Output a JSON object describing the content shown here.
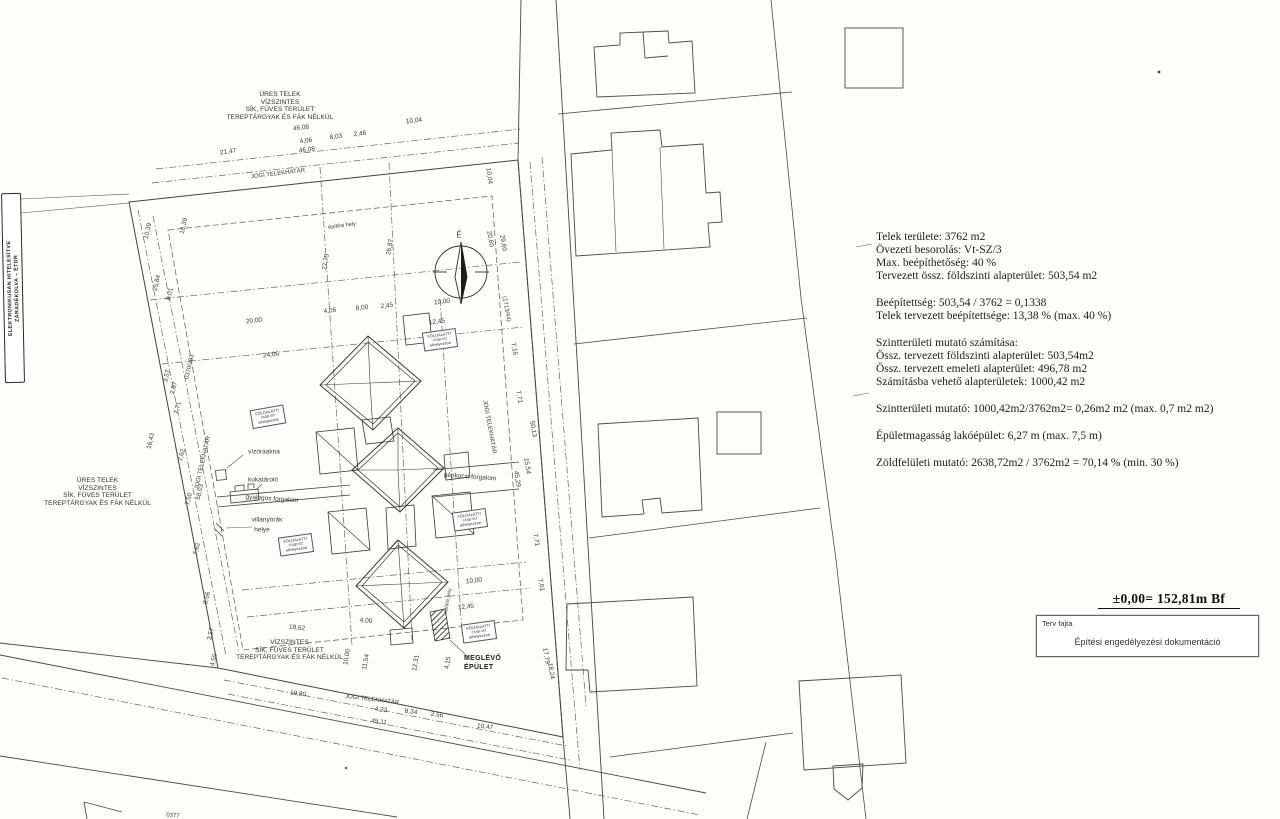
{
  "stamp": {
    "line1": "ELEKTRONIKUSAN HITELESÍTVE",
    "line2": "ZÁRADÉKOLVA – ÉTDR"
  },
  "notes": {
    "top_left": [
      "ÜRES TELEK",
      "VÍZSZINTES",
      "SÍK, FÜVES TERÜLET",
      "TEREPTÁRGYAK ÉS FÁK NÉLKÜL"
    ],
    "left": [
      "ÜRES TELEK",
      "VÍZSZINTES",
      "SÍK, FÜVES TERÜLET",
      "TEREPTÁRGYAK ÉS FÁK NÉLKÜL"
    ],
    "bottom": [
      "VÍZSZINTES",
      "SÍK, FÜVES TERÜLET",
      "TEREPTÁRGYAK ÉS FÁK NÉLKÜL"
    ]
  },
  "info_block": {
    "paragraphs": [
      [
        "Telek területe: 3762 m2",
        "Övezeti besorolás: Vt-SZ/3",
        "Max. beépíthetőség: 40 %",
        "Tervezett össz. földszinti alapterület: 503,54 m2"
      ],
      [
        "Beépítettség: 503,54 / 3762 = 0,1338",
        "Telek tervezett beépítettsége: 13,38 % (max. 40 %)"
      ],
      [
        "Szintterületi mutató számítása:",
        "Össz. tervezett földszinti alapterület: 503,54m2",
        "Össz. tervezett emeleti alapterület: 496,78 m2",
        "Számításba vehető alapterületek: 1000,42 m2"
      ],
      [
        "Szintterületi mutató: 1000,42m2/3762m2= 0,26m2 m2  (max. 0,7 m2 m2)"
      ],
      [
        "Épületmagasság lakóépület: 6,27 m (max. 7,5 m)"
      ],
      [
        "Zöldfelületi mutató: 2638,72m2 / 3762m2 = 70,14 % (min. 30 %)"
      ]
    ]
  },
  "datum": "±0,00= 152,81m Bf",
  "title_block": {
    "label": "Terv fajta",
    "value": "Építési engedélyezési dokumentáció"
  },
  "existing_building": {
    "line1": "MEGLÉVŐ",
    "line2": "ÉPÜLET"
  },
  "underground_boxes": {
    "lines": [
      "FÖLDALATTI",
      "csap.víz",
      "elhelyezése"
    ],
    "positions": [
      {
        "x": 268,
        "y": 417,
        "r": -10
      },
      {
        "x": 296,
        "y": 545,
        "r": -8
      },
      {
        "x": 470,
        "y": 520,
        "r": -8
      },
      {
        "x": 479,
        "y": 632,
        "r": -8
      },
      {
        "x": 440,
        "y": 340,
        "r": -8
      }
    ]
  },
  "annotations": [
    {
      "t": "46,08",
      "x": 301,
      "y": 128,
      "r": -7
    },
    {
      "t": "4,06",
      "x": 306,
      "y": 141,
      "r": -7
    },
    {
      "t": "8,03",
      "x": 336,
      "y": 137,
      "r": -7
    },
    {
      "t": "2,46",
      "x": 360,
      "y": 134,
      "r": -7
    },
    {
      "t": "10,04",
      "x": 414,
      "y": 121,
      "r": -7
    },
    {
      "t": "21,47",
      "x": 228,
      "y": 152,
      "r": -7
    },
    {
      "t": "46,08",
      "x": 307,
      "y": 150,
      "r": -7
    },
    {
      "t": "JOGI TELEKHATÁR",
      "x": 278,
      "y": 174,
      "r": -7,
      "fs": 6
    },
    {
      "t": "10,04",
      "x": 489,
      "y": 176,
      "r": 83
    },
    {
      "t": "10,39",
      "x": 148,
      "y": 231,
      "r": -77
    },
    {
      "t": "10,39",
      "x": 184,
      "y": 226,
      "r": -77
    },
    {
      "t": "25,84",
      "x": 157,
      "y": 283,
      "r": -77
    },
    {
      "t": "8,01",
      "x": 170,
      "y": 294,
      "r": -77
    },
    {
      "t": "0370/293",
      "x": 190,
      "y": 367,
      "r": -77,
      "fs": 6
    },
    {
      "t": "3,57",
      "x": 167,
      "y": 376,
      "r": -77
    },
    {
      "t": "2,97",
      "x": 174,
      "y": 388,
      "r": -77
    },
    {
      "t": "7,71",
      "x": 178,
      "y": 408,
      "r": -77
    },
    {
      "t": "16,43",
      "x": 151,
      "y": 441,
      "r": -77
    },
    {
      "t": "7,62",
      "x": 182,
      "y": 455,
      "r": -77
    },
    {
      "t": "JOGI TELEKHATÁR",
      "x": 203,
      "y": 463,
      "r": -77,
      "fs": 6
    },
    {
      "t": "7,50",
      "x": 189,
      "y": 499,
      "r": -77
    },
    {
      "t": "58,03",
      "x": 200,
      "y": 492,
      "r": -77
    },
    {
      "t": "7,62",
      "x": 197,
      "y": 549,
      "r": -77
    },
    {
      "t": "8,56",
      "x": 207,
      "y": 598,
      "r": -77
    },
    {
      "t": "3,57",
      "x": 211,
      "y": 634,
      "r": -77
    },
    {
      "t": "4,55",
      "x": 214,
      "y": 660,
      "r": -77
    },
    {
      "t": "20,60",
      "x": 490,
      "y": 239,
      "r": 80
    },
    {
      "t": "29,60",
      "x": 503,
      "y": 243,
      "r": 80
    },
    {
      "t": "(1713/44)",
      "x": 506,
      "y": 309,
      "r": 80,
      "fs": 6
    },
    {
      "t": "7,16",
      "x": 514,
      "y": 349,
      "r": 80
    },
    {
      "t": "7,71",
      "x": 519,
      "y": 397,
      "r": 80
    },
    {
      "t": "50,13",
      "x": 533,
      "y": 429,
      "r": 80
    },
    {
      "t": "15,54",
      "x": 527,
      "y": 466,
      "r": 80
    },
    {
      "t": "45,29",
      "x": 517,
      "y": 479,
      "r": 80
    },
    {
      "t": "JOGI TELEKHATÁR",
      "x": 489,
      "y": 427,
      "r": 80,
      "fs": 6
    },
    {
      "t": "7,71",
      "x": 536,
      "y": 540,
      "r": 80
    },
    {
      "t": "7,61",
      "x": 541,
      "y": 585,
      "r": 80
    },
    {
      "t": "17,79",
      "x": 546,
      "y": 656,
      "r": 80
    },
    {
      "t": "18,24",
      "x": 551,
      "y": 671,
      "r": 80
    },
    {
      "t": "19,80",
      "x": 298,
      "y": 694,
      "r": 7
    },
    {
      "t": "JOGI TELEKHATÁR",
      "x": 372,
      "y": 700,
      "r": 7,
      "fs": 6
    },
    {
      "t": "4,23",
      "x": 381,
      "y": 710,
      "r": 7
    },
    {
      "t": "8,34",
      "x": 411,
      "y": 712,
      "r": 7
    },
    {
      "t": "2,56",
      "x": 437,
      "y": 715,
      "r": 7
    },
    {
      "t": "45,11",
      "x": 379,
      "y": 722,
      "r": 7
    },
    {
      "t": "10,47",
      "x": 485,
      "y": 727,
      "r": 7
    },
    {
      "t": "0377",
      "x": 173,
      "y": 816,
      "r": 4,
      "fs": 6
    },
    {
      "t": "20,00",
      "x": 254,
      "y": 321,
      "r": -7
    },
    {
      "t": "24,06",
      "x": 271,
      "y": 355,
      "r": -7
    },
    {
      "t": "4,06",
      "x": 330,
      "y": 311,
      "r": -7
    },
    {
      "t": "8,00",
      "x": 362,
      "y": 308,
      "r": -7
    },
    {
      "t": "2,45",
      "x": 387,
      "y": 306,
      "r": -7
    },
    {
      "t": "10,00",
      "x": 442,
      "y": 302,
      "r": -7
    },
    {
      "t": "12,45",
      "x": 437,
      "y": 322,
      "r": -7
    },
    {
      "t": "27,75",
      "x": 326,
      "y": 262,
      "r": -80
    },
    {
      "t": "26,87",
      "x": 390,
      "y": 247,
      "r": -80
    },
    {
      "t": "építési hely",
      "x": 342,
      "y": 226,
      "r": -7,
      "fs": 5.5
    },
    {
      "t": "10,00",
      "x": 474,
      "y": 581,
      "r": -7
    },
    {
      "t": "12,45",
      "x": 466,
      "y": 607,
      "r": -7
    },
    {
      "t": "építési hely",
      "x": 448,
      "y": 601,
      "r": -80,
      "fs": 5
    },
    {
      "t": "18,62",
      "x": 297,
      "y": 628,
      "r": 6
    },
    {
      "t": "4,00",
      "x": 366,
      "y": 621,
      "r": 6
    },
    {
      "t": "10,00",
      "x": 347,
      "y": 657,
      "r": -80
    },
    {
      "t": "11,54",
      "x": 366,
      "y": 662,
      "r": -80
    },
    {
      "t": "12,31",
      "x": 416,
      "y": 663,
      "r": -80
    },
    {
      "t": "4,15",
      "x": 448,
      "y": 663,
      "r": -80
    },
    {
      "t": "vízóraakna",
      "x": 264,
      "y": 452,
      "r": 0
    },
    {
      "t": "kukatároló",
      "x": 263,
      "y": 480,
      "r": 0
    },
    {
      "t": "gyalogos forgalom",
      "x": 272,
      "y": 499,
      "r": 4
    },
    {
      "t": "villanyórák",
      "x": 267,
      "y": 520,
      "r": 0
    },
    {
      "t": "helye",
      "x": 262,
      "y": 530,
      "r": 0
    },
    {
      "t": "gépkocsi forgalom",
      "x": 470,
      "y": 477,
      "r": 4
    },
    {
      "t": "É",
      "x": 459,
      "y": 235,
      "r": 0,
      "fs": 8
    }
  ]
}
